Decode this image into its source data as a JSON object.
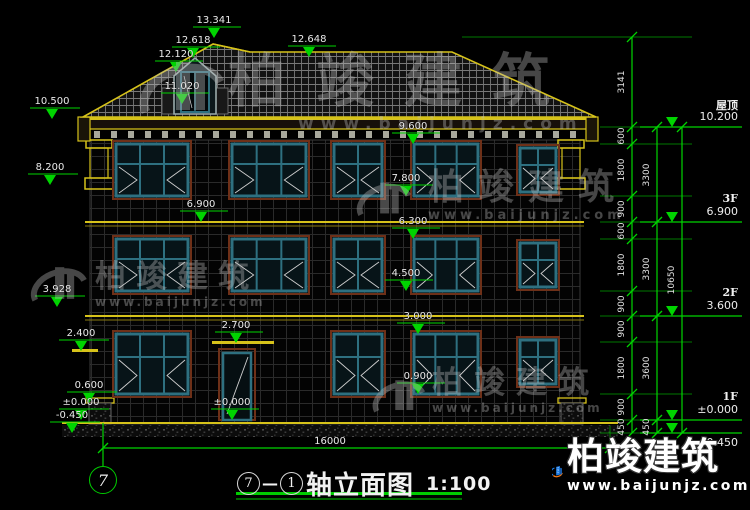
{
  "title": {
    "axis_start": "7",
    "separator": "—",
    "axis_end": "1",
    "name": "轴立面图",
    "scale": "1:100"
  },
  "axis_bubble": "7",
  "watermark": {
    "brand": "柏竣建筑",
    "url": "www.baijunjz.com"
  },
  "logo": {
    "brand": "柏竣建筑",
    "url": "www.baijunjz.com"
  },
  "dims": {
    "bottom_total": "16000",
    "outer_chain": [
      "3141",
      "600",
      "1800",
      "900",
      "600",
      "1800",
      "900",
      "900",
      "1800",
      "900",
      "450"
    ],
    "mid_chain": [
      "3300",
      "3300",
      "3600",
      "450"
    ],
    "grand_total": "10650"
  },
  "levels_right": [
    {
      "name": "屋顶",
      "elev": "10.200"
    },
    {
      "name": "3F",
      "elev": "6.900"
    },
    {
      "name": "2F",
      "elev": "3.600"
    },
    {
      "name": "1F",
      "elev": "±0.000"
    },
    {
      "name": "",
      "elev": "-0.450"
    }
  ],
  "marks_top": [
    "13.341",
    "12.618",
    "12.120",
    "11.020",
    "12.648"
  ],
  "marks_left": [
    "10.500",
    "8.200",
    "3.928",
    "2.400",
    "0.600",
    "±0.000",
    "-0.450"
  ],
  "marks_face": [
    "9.600",
    "7.800",
    "6.900",
    "6.300",
    "4.500",
    "3.000",
    "2.700",
    "0.900",
    "±0.000"
  ]
}
